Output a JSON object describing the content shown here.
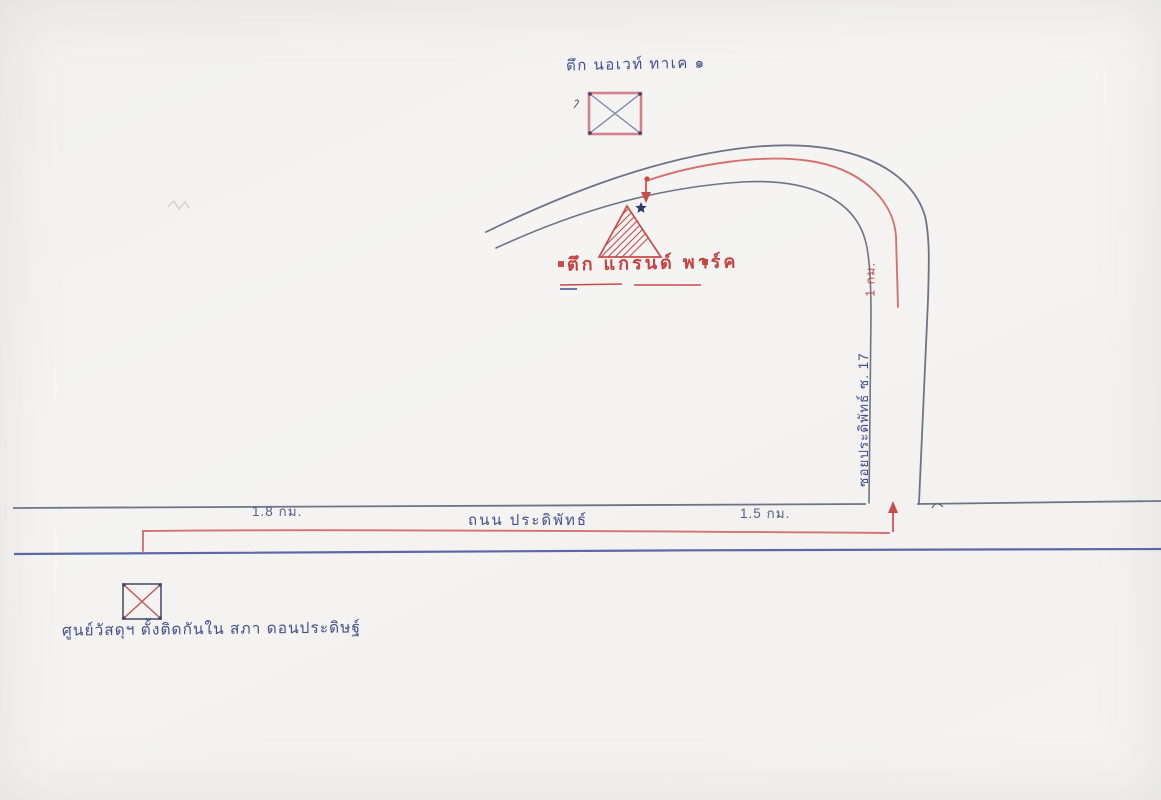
{
  "map": {
    "top_landmark": {
      "label": "ตึก นอเวท์ ทาเค ๑",
      "marker": "crossed-box-icon"
    },
    "center_landmark": {
      "label": "ตึก แกรนด์ พาร์ค",
      "marker": "hatched-triangle-icon",
      "star": "star-icon",
      "flanking_marks": "red asterisk squares"
    },
    "bottom_landmark": {
      "label": "ศูนย์วัสดุฯ ตั้งติดกันใน สภา ดอนประดิษฐ์",
      "marker": "crossed-box-icon"
    },
    "horizontal_road": {
      "name": "ถนน ประดิพัทธ์",
      "distance_left": "1.8 กม.",
      "distance_right": "1.5 กม."
    },
    "vertical_road": {
      "name": "ซอยประดิพัทธ์ ซ. 17",
      "distance": "1 กม."
    },
    "route": {
      "style": "red line with arrowheads",
      "arrows": "arrow-icon"
    },
    "colors": {
      "paper": "#f4f3f1",
      "blue_ink": "#44508c",
      "red_ink": "#c8403f",
      "route_red": "#d97070",
      "road_line": "#6e7487",
      "road_line_blue": "#5c67a5"
    }
  }
}
